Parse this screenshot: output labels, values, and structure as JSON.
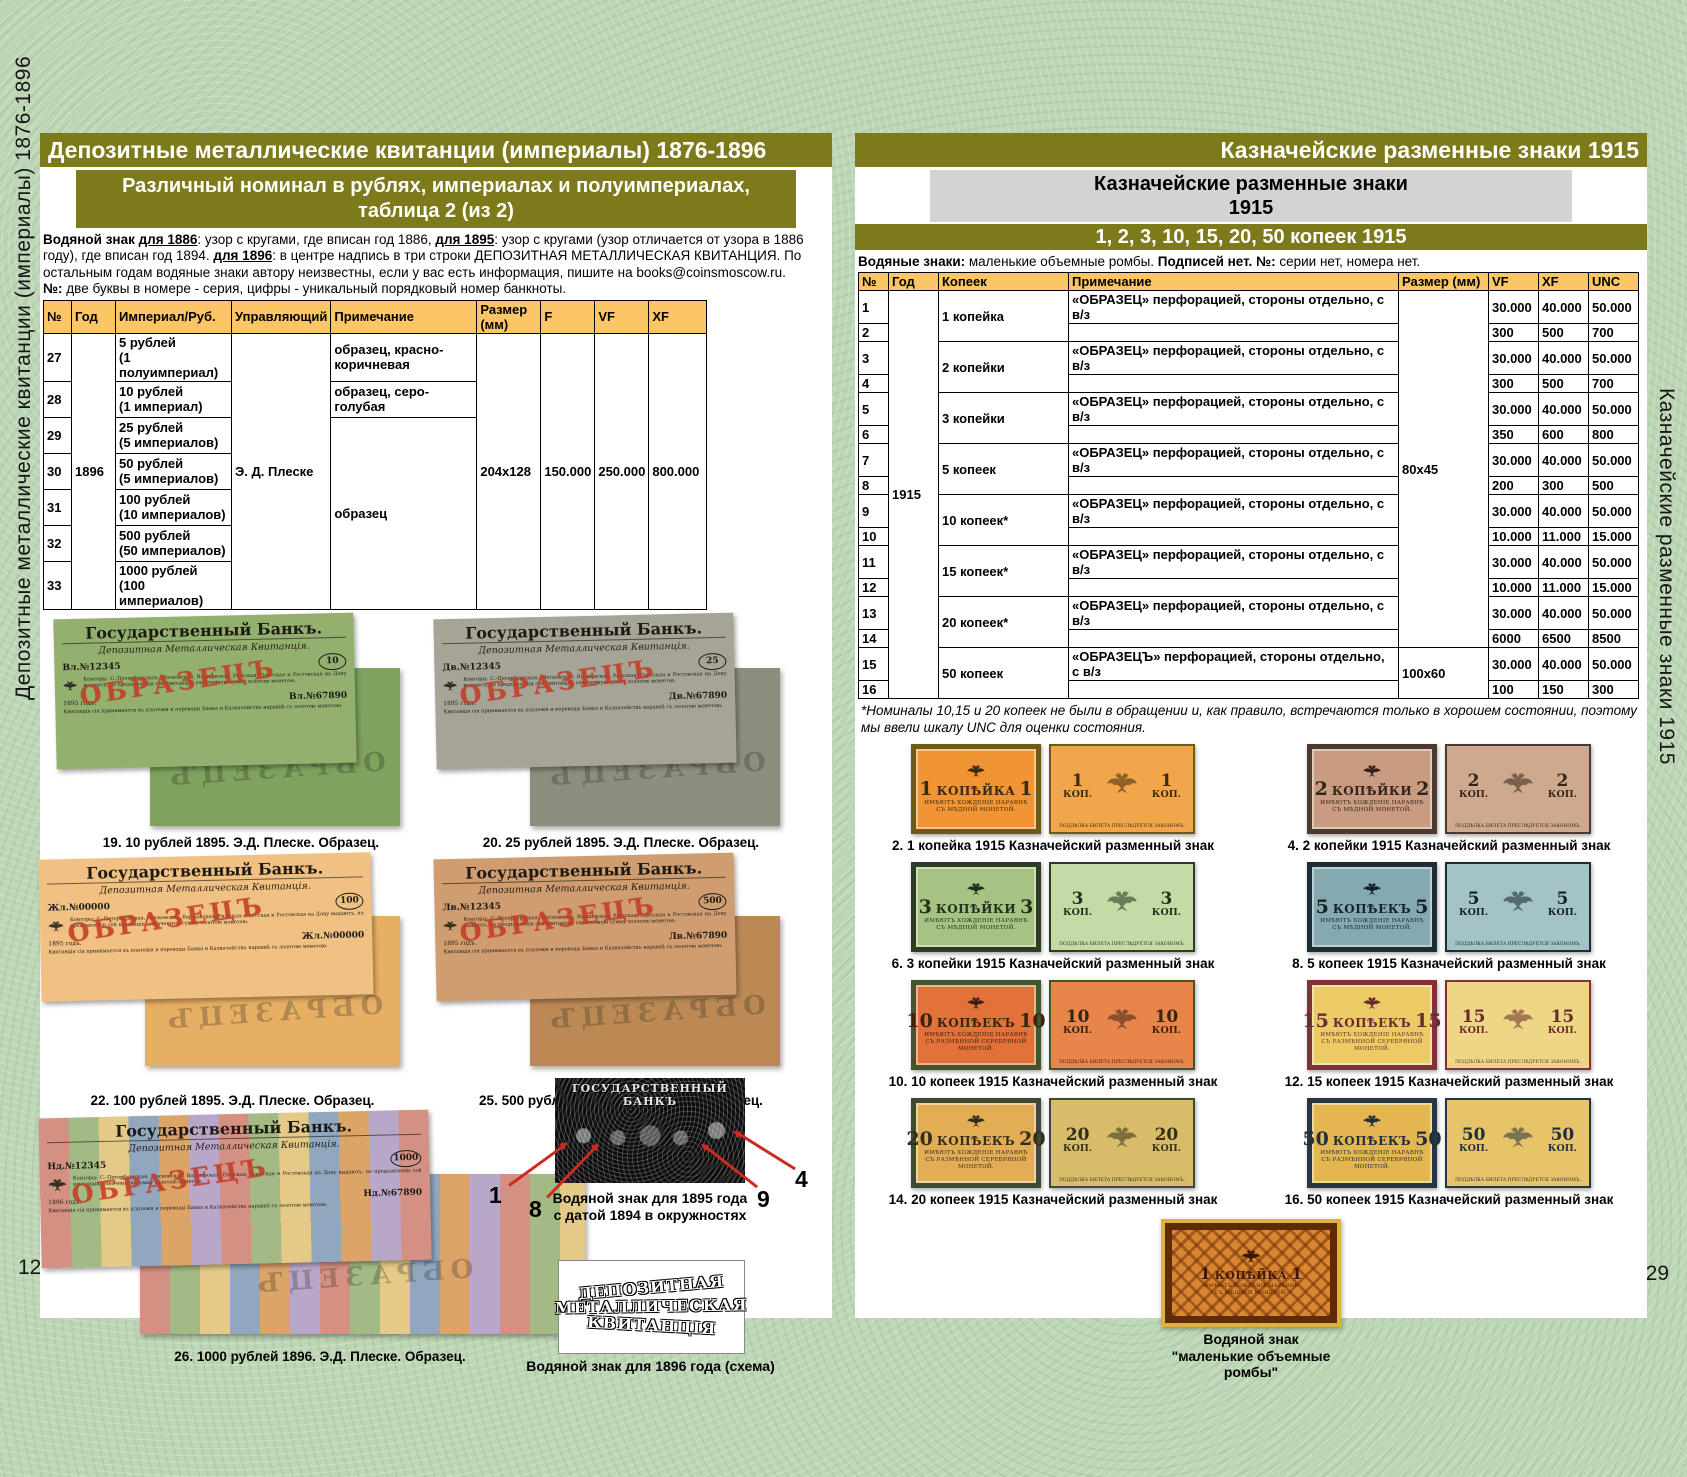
{
  "colors": {
    "olive": "#7d7a1b",
    "table_header": "#fcc565",
    "gray_box": "#d3d3d3",
    "accent_red": "#cc2b20",
    "page_bg": "#bdd6b5"
  },
  "left_page": {
    "page_number": "128",
    "sidebar_label": "Депозитные металлические квитанции (империалы) 1876-1896",
    "header": "Депозитные металлические квитанции (империалы) 1876-1896",
    "subheader_line1": "Различный номинал в рублях, империалах и полуимпериалах,",
    "subheader_line2": "таблица 2 (из 2)",
    "intro": [
      {
        "t": "Водяной знак ",
        "b": 1
      },
      {
        "t": "для 1886",
        "b": 1,
        "u": 1
      },
      {
        "t": ": узор с кругами, где вписан год 1886, "
      },
      {
        "t": "для 1895",
        "b": 1,
        "u": 1
      },
      {
        "t": ": узор с кругами (узор отличается от узора в 1886 году), где вписан год 1894. "
      },
      {
        "t": "для 1896",
        "b": 1,
        "u": 1
      },
      {
        "t": ": в центре надпись в три строки ДЕПОЗИТНАЯ МЕТАЛЛИЧЕСКАЯ КВИТАНЦИЯ. По остальным годам водяные знаки автору неизвестны, если у вас есть информация, пишите на books@coinsmoscow.ru."
      },
      {
        "t": "\n№:",
        "b": 1
      },
      {
        "t": " две буквы в номере - серия, цифры - уникальный порядковый номер банкноты."
      }
    ],
    "table": {
      "headers": [
        "№",
        "Год",
        "Империал/Руб.",
        "Управляющий",
        "Примечание",
        "Размер (мм)",
        "F",
        "VF",
        "XF"
      ],
      "year": "1896",
      "manager": "Э. Д. Плеске",
      "size": "204x128",
      "f": "150.000",
      "vf": "250.000",
      "xf": "800.000",
      "rows": [
        {
          "no": "27",
          "denom1": "5 рублей",
          "denom2": "(1 полуимпериал)",
          "note": "образец, красно-коричневая"
        },
        {
          "no": "28",
          "denom1": "10 рублей",
          "denom2": "(1 империал)",
          "note": "образец, серо-голубая"
        },
        {
          "no": "29",
          "denom1": "25 рублей",
          "denom2": "(5 империалов)",
          "note": "образец"
        },
        {
          "no": "30",
          "denom1": "50 рублей",
          "denom2": "(5 империалов)"
        },
        {
          "no": "31",
          "denom1": "100 рублей",
          "denom2": "(10 империалов)"
        },
        {
          "no": "32",
          "denom1": "500 рублей",
          "denom2": "(50 империалов)"
        },
        {
          "no": "33",
          "denom1": "1000 рублей",
          "denom2": "(100 империалов)"
        }
      ]
    },
    "note_texts": {
      "bank_title": "Государственный Банкъ.",
      "doc_title": "Депозитная Металлическая Квитанція.",
      "paragraph": "Конторы: С.-Петербургская, Московская, Варшавская, Рижская, Одесская и Ростовская на Дону выдаютъ, по предъявленіи сей квитанціи, означенную сумму золотою монетою.",
      "paragraph2": "Квитанція сія принимается въ платежи и переводы Банка и Казначействъ наравнѣ съ золотою монетою.",
      "obrazec": "ОБРАЗЕЦЪ"
    },
    "figures": [
      {
        "caption": "19. 10 рублей 1895. Э.Д. Плеске. Образец.",
        "num": "10",
        "serial": "Вл.№12345",
        "serial2": "Вл.№67890",
        "year": "1895 годъ.",
        "front_bg": "#93b06f",
        "back_bg": "#7fa35e"
      },
      {
        "caption": "20. 25 рублей 1895. Э.Д. Плеске. Образец.",
        "num": "25",
        "serial": "Дв.№12345",
        "serial2": "Дв.№67890",
        "year": "1895 годъ.",
        "front_bg": "#a5a496",
        "back_bg": "#8e8e7e"
      },
      {
        "caption": "22. 100 рублей 1895. Э.Д. Плеске. Образец.",
        "num": "100",
        "serial": "Жл.№00000",
        "serial2": "Жл.№00000",
        "year": "1895 годъ.",
        "front_bg": "#f0c183",
        "back_bg": "#e7af64"
      },
      {
        "caption": "25. 500 рублей 1895. Э.Д. Плеске. Образец.",
        "num": "500",
        "serial": "Лв.№12345",
        "serial2": "Лв.№67890",
        "year": "1895 годъ.",
        "front_bg": "#cf9d70",
        "back_bg": "#bc8955"
      },
      {
        "caption": "26. 1000 рублей 1896. Э.Д. Плеске. Образец.",
        "num": "1000",
        "serial": "Нд.№12345",
        "serial2": "Нд.№67890",
        "year": "1896 годъ.",
        "front_bg": "stripes",
        "back_bg": "stripes"
      }
    ],
    "wm1895": {
      "img_title": "ГОСУДАРСТВЕННЫЙ БАНКЪ",
      "numbers": [
        "1",
        "8",
        "9",
        "4"
      ],
      "caption_line1": "Водяной знак для 1895 года",
      "caption_line2": "с датой 1894 в окружностях"
    },
    "wm1896": {
      "lines": [
        "ДЕПОЗИТНАЯ",
        "МЕТАЛЛИЧЕСКАЯ",
        "КВИТАНЦІЯ"
      ],
      "caption": "Водяной знак для 1896 года (схема)"
    }
  },
  "right_page": {
    "page_number": "129",
    "sidebar_label": "Казначейские разменные знаки 1915",
    "header": "Казначейские разменные знаки 1915",
    "graybox_line1": "Казначейские разменные знаки",
    "graybox_line2": "1915",
    "oliveline": "1, 2, 3, 10, 15, 20, 50 копеек 1915",
    "intro": [
      {
        "t": "Водяные знаки:",
        "b": 1
      },
      {
        "t": " маленькие объемные ромбы. "
      },
      {
        "t": "Подписей нет.",
        "b": 1
      },
      {
        "t": " "
      },
      {
        "t": "№:",
        "b": 1
      },
      {
        "t": " серии нет, номера нет."
      }
    ],
    "table": {
      "headers": [
        "№",
        "Год",
        "Копеек",
        "Примечание",
        "Размер (мм)",
        "VF",
        "XF",
        "UNC"
      ],
      "year": "1915",
      "size_top": "80x45",
      "size_bottom": "100x60",
      "note_standard": "«ОБРАЗЕЦ» перфорацией, стороны отдельно, с в/з",
      "note_50": "«ОБРАЗЕЦЪ» перфорацией, стороны отдельно, с в/з",
      "groups": [
        {
          "kopek": "1 копейка",
          "rows": [
            [
              "1",
              "30.000",
              "40.000",
              "50.000"
            ],
            [
              "2",
              "300",
              "500",
              "700"
            ]
          ]
        },
        {
          "kopek": "2 копейки",
          "rows": [
            [
              "3",
              "30.000",
              "40.000",
              "50.000"
            ],
            [
              "4",
              "300",
              "500",
              "700"
            ]
          ]
        },
        {
          "kopek": "3 копейки",
          "rows": [
            [
              "5",
              "30.000",
              "40.000",
              "50.000"
            ],
            [
              "6",
              "350",
              "600",
              "800"
            ]
          ]
        },
        {
          "kopek": "5 копеек",
          "rows": [
            [
              "7",
              "30.000",
              "40.000",
              "50.000"
            ],
            [
              "8",
              "200",
              "300",
              "500"
            ]
          ]
        },
        {
          "kopek": "10 копеек*",
          "rows": [
            [
              "9",
              "30.000",
              "40.000",
              "50.000"
            ],
            [
              "10",
              "10.000",
              "11.000",
              "15.000"
            ]
          ]
        },
        {
          "kopek": "15 копеек*",
          "rows": [
            [
              "11",
              "30.000",
              "40.000",
              "50.000"
            ],
            [
              "12",
              "10.000",
              "11.000",
              "15.000"
            ]
          ]
        },
        {
          "kopek": "20 копеек*",
          "rows": [
            [
              "13",
              "30.000",
              "40.000",
              "50.000"
            ],
            [
              "14",
              "6000",
              "6500",
              "8500"
            ]
          ]
        },
        {
          "kopek": "50 копеек",
          "rows": [
            [
              "15",
              "30.000",
              "40.000",
              "50.000"
            ],
            [
              "16",
              "100",
              "150",
              "300"
            ]
          ]
        }
      ]
    },
    "footnote": "*Номиналы 10,15 и 20 копеек не были в обращении и, как правило, встречаются только в хорошем состоянии, поэтому мы ввели шкалу UNC для оценки состояния.",
    "note_texts": {
      "small1": "ИМѢЮТЪ ХОЖДЕНІЕ НАРАВНѢ",
      "small2_copper": "СЪ МѢДНОЙ МОНЕТОЙ.",
      "small2_silver": "СЪ РАЗМѢННОЙ СЕРЕБРЯНОЙ МОНЕТОЙ.",
      "back_kop": "КОП.",
      "back_small": "ПОДДѢЛКА БИЛЕТА ПРЕСЛѢДУЕТСЯ ЗАКОНОМЪ."
    },
    "banknotes": [
      {
        "caption": "2. 1 копейка 1915 Казначейский разменный знак",
        "num": "1",
        "word": "КОПѢЙКА",
        "metal": "copper",
        "front_bg": "#f09434",
        "border": "#6b5a19",
        "back_bg": "#f2a64a",
        "ink": "#3a2a10"
      },
      {
        "caption": "4. 2 копейки 1915 Казначейский разменный знак",
        "num": "2",
        "word": "КОПѢЙКИ",
        "metal": "copper",
        "front_bg": "#c99b80",
        "border": "#4a3a30",
        "back_bg": "#cfa98d",
        "ink": "#32241c"
      },
      {
        "caption": "6. 3 копейки 1915 Казначейский разменный знак",
        "num": "3",
        "word": "КОПѢЙКИ",
        "metal": "copper",
        "front_bg": "#a6c383",
        "border": "#2c3d24",
        "back_bg": "#c6daa6",
        "ink": "#22301c"
      },
      {
        "caption": "8. 5 копеек 1915 Казначейский разменный знак",
        "num": "5",
        "word": "КОПѢЕКЪ",
        "metal": "copper",
        "front_bg": "#84a9b0",
        "border": "#1d2d38",
        "back_bg": "#a3c3c6",
        "ink": "#16222b"
      },
      {
        "caption": "10. 10 копеек 1915 Казначейский разменный знак",
        "num": "10",
        "word": "КОПѢЕКЪ",
        "metal": "silver",
        "front_bg": "#e2713a",
        "border": "#43552c",
        "back_bg": "#e8854a",
        "ink": "#3a2410"
      },
      {
        "caption": "12. 15 копеек 1915 Казначейский разменный знак",
        "num": "15",
        "word": "КОПѢЕКЪ",
        "metal": "silver",
        "front_bg": "#ecca66",
        "border": "#833138",
        "back_bg": "#eed687",
        "ink": "#6b2a2e"
      },
      {
        "caption": "14. 20 копеек 1915 Казначейский разменный знак",
        "num": "20",
        "word": "КОПѢЕКЪ",
        "metal": "silver",
        "front_bg": "#e2ad55",
        "border": "#3e4a33",
        "back_bg": "#d9bc6a",
        "ink": "#33301a"
      },
      {
        "caption": "16. 50 копеек 1915 Казначейский разменный знак",
        "num": "50",
        "word": "КОПѢЕКЪ",
        "metal": "silver",
        "front_bg": "#e3b650",
        "border": "#263645",
        "back_bg": "#e7c469",
        "ink": "#22303e"
      }
    ],
    "wm_right": {
      "num": "1",
      "word": "КОПѢЙКА",
      "caption_lines": [
        "Водяной знак",
        "\"маленькие объемные",
        "ромбы\""
      ]
    }
  }
}
